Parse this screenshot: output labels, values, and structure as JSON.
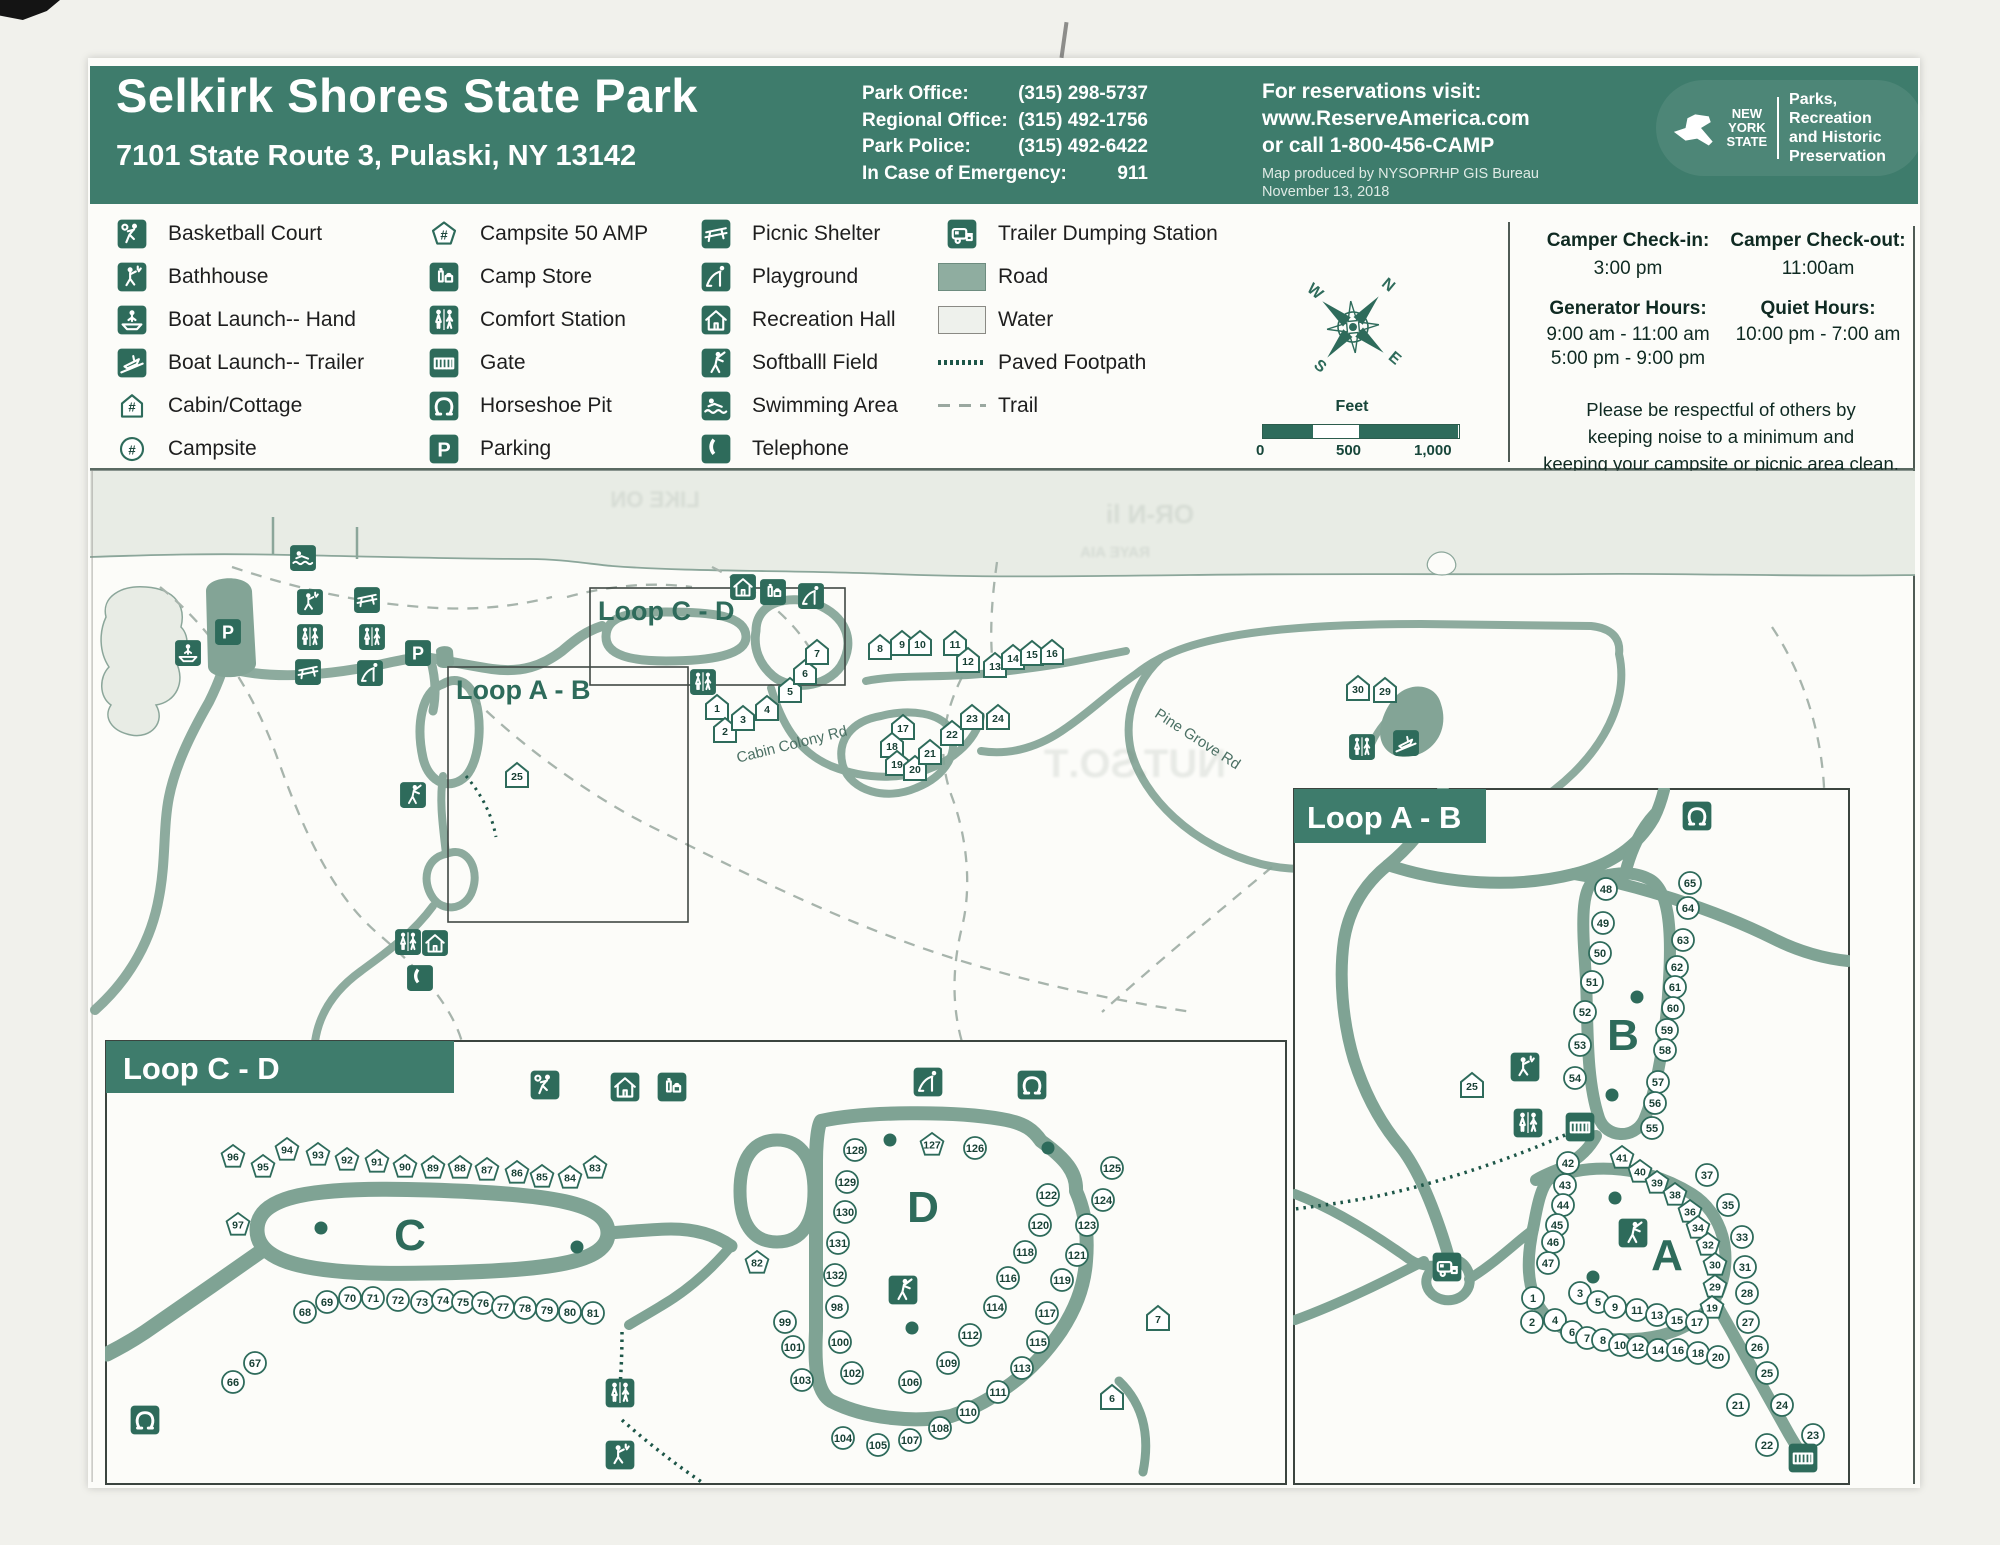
{
  "header": {
    "title": "Selkirk Shores State Park",
    "address": "7101 State Route 3, Pulaski, NY 13142",
    "contacts": [
      {
        "label": "Park Office:",
        "value": "(315) 298-5737"
      },
      {
        "label": "Regional Office:",
        "value": "(315) 492-1756"
      },
      {
        "label": "Park Police:",
        "value": "(315) 492-6422"
      },
      {
        "label": "In Case of Emergency:",
        "value": "911"
      }
    ],
    "reservations": [
      "For reservations visit:",
      "www.ReserveAmerica.com",
      "or call 1-800-456-CAMP"
    ],
    "produced": [
      "Map produced by NYSOPRHP GIS Bureau",
      "November 13, 2018"
    ],
    "logo": {
      "state": [
        "NEW",
        "YORK",
        "STATE"
      ],
      "dept": [
        "Parks, Recreation",
        "and Historic",
        "Preservation"
      ]
    }
  },
  "legend": {
    "columns": [
      [
        {
          "icon": "basketball",
          "label": "Basketball Court"
        },
        {
          "icon": "bathhouse",
          "label": "Bathhouse"
        },
        {
          "icon": "boat-hand",
          "label": "Boat Launch-- Hand"
        },
        {
          "icon": "boat-trailer",
          "label": "Boat Launch-- Trailer"
        },
        {
          "icon": "cabin",
          "label": "Cabin/Cottage"
        },
        {
          "icon": "campsite",
          "label": "Campsite"
        }
      ],
      [
        {
          "icon": "campsite50",
          "label": "Campsite 50 AMP"
        },
        {
          "icon": "campstore",
          "label": "Camp Store"
        },
        {
          "icon": "comfort",
          "label": "Comfort Station"
        },
        {
          "icon": "gate",
          "label": "Gate"
        },
        {
          "icon": "horseshoe",
          "label": "Horseshoe Pit"
        },
        {
          "icon": "parking",
          "label": "Parking"
        }
      ],
      [
        {
          "icon": "picnic",
          "label": "Picnic Shelter"
        },
        {
          "icon": "playground",
          "label": "Playground"
        },
        {
          "icon": "rechall",
          "label": "Recreation Hall"
        },
        {
          "icon": "softball",
          "label": "Softballl Field"
        },
        {
          "icon": "swim",
          "label": "Swimming Area"
        },
        {
          "icon": "telephone",
          "label": "Telephone"
        }
      ],
      [
        {
          "icon": "dump",
          "label": "Trailer Dumping Station"
        },
        {
          "icon": "road-swatch",
          "label": "Road",
          "variant": "swatch"
        },
        {
          "icon": "water-swatch",
          "label": "Water",
          "variant": "swatch"
        },
        {
          "icon": "footpath-line",
          "label": "Paved Footpath",
          "variant": "line"
        },
        {
          "icon": "trail-line",
          "label": "Trail",
          "variant": "line"
        }
      ]
    ]
  },
  "info_panel": {
    "checkin_title": "Camper Check-in:",
    "checkin_value": "3:00 pm",
    "checkout_title": "Camper Check-out:",
    "checkout_value": "11:00am",
    "generator_title": "Generator Hours:",
    "generator_lines": [
      "9:00 am - 11:00 am",
      "5:00 pm - 9:00 pm"
    ],
    "quiet_title": "Quiet Hours:",
    "quiet_value": "10:00 pm - 7:00 am",
    "note": [
      "Please be respectful of others by",
      "keeping noise to a minimum and",
      "keeping your campsite or picnic area clean."
    ]
  },
  "scalebar": {
    "label": "Feet",
    "ticks": [
      "0",
      "500",
      "1,000"
    ]
  },
  "compass": {
    "letters": [
      "N",
      "E",
      "S",
      "W"
    ]
  },
  "colors": {
    "header_green": "#3e7c6c",
    "icon_green": "#2e6b5b",
    "road": "#83a496",
    "water": "#e8ece5"
  },
  "main_map": {
    "boxes": [
      {
        "label": "Loop C - D"
      },
      {
        "label": "Loop A - B"
      }
    ],
    "road_labels": [
      {
        "text": "Cabin Colony Rd"
      },
      {
        "text": "Pine Grove Rd"
      }
    ],
    "cabins": [
      [
        1,
        627,
        242
      ],
      [
        2,
        635,
        265
      ],
      [
        3,
        653,
        253
      ],
      [
        4,
        677,
        243
      ],
      [
        5,
        700,
        225
      ],
      [
        6,
        715,
        207
      ],
      [
        7,
        727,
        187
      ],
      [
        8,
        790,
        182
      ],
      [
        9,
        812,
        178
      ],
      [
        10,
        830,
        178
      ],
      [
        11,
        865,
        178
      ],
      [
        12,
        878,
        195
      ],
      [
        13,
        905,
        200
      ],
      [
        14,
        923,
        192
      ],
      [
        15,
        942,
        188
      ],
      [
        16,
        962,
        187
      ],
      [
        17,
        813,
        262
      ],
      [
        18,
        802,
        280
      ],
      [
        19,
        807,
        298
      ],
      [
        20,
        825,
        303
      ],
      [
        21,
        840,
        287
      ],
      [
        22,
        862,
        268
      ],
      [
        23,
        882,
        252
      ],
      [
        24,
        908,
        252
      ],
      [
        25,
        427,
        310
      ],
      [
        29,
        1295,
        225
      ],
      [
        30,
        1268,
        223
      ]
    ],
    "icons": [
      [
        "swim",
        213,
        93
      ],
      [
        "boat-hand",
        98,
        188
      ],
      [
        "parking",
        138,
        167
      ],
      [
        "bathhouse",
        220,
        137
      ],
      [
        "picnic",
        277,
        135
      ],
      [
        "comfort",
        220,
        172
      ],
      [
        "comfort",
        282,
        172
      ],
      [
        "picnic",
        218,
        207
      ],
      [
        "playground",
        280,
        208
      ],
      [
        "parking",
        328,
        188
      ],
      [
        "softball",
        323,
        330
      ],
      [
        "comfort",
        613,
        217
      ],
      [
        "rechall",
        653,
        122
      ],
      [
        "campstore",
        683,
        127
      ],
      [
        "playground",
        721,
        131
      ],
      [
        "comfort",
        318,
        477
      ],
      [
        "rechall",
        345,
        478
      ],
      [
        "telephone",
        330,
        513
      ],
      [
        "comfort",
        1272,
        282
      ],
      [
        "boat-trailer",
        1316,
        278
      ]
    ],
    "artifacts": [
      {
        "text": "OR-N li",
        "x": 1060,
        "y": 58,
        "s": 26
      },
      {
        "text": "RAYE AIA",
        "x": 1025,
        "y": 92,
        "s": 15
      },
      {
        "text": "LIKE ON",
        "x": 565,
        "y": 42,
        "s": 22
      },
      {
        "text": "NUT.SO.T",
        "x": 1045,
        "y": 312,
        "s": 40
      }
    ]
  },
  "inset_cd": {
    "title": "Loop C - D",
    "letters": [
      {
        "t": "C",
        "x": 305,
        "y": 210
      },
      {
        "t": "D",
        "x": 818,
        "y": 182
      }
    ],
    "pentagons": [
      [
        96,
        128,
        117
      ],
      [
        95,
        158,
        127
      ],
      [
        94,
        182,
        110
      ],
      [
        93,
        213,
        115
      ],
      [
        92,
        242,
        120
      ],
      [
        91,
        272,
        122
      ],
      [
        90,
        300,
        127
      ],
      [
        89,
        328,
        128
      ],
      [
        88,
        355,
        128
      ],
      [
        87,
        382,
        130
      ],
      [
        86,
        412,
        133
      ],
      [
        85,
        437,
        137
      ],
      [
        84,
        465,
        138
      ],
      [
        83,
        490,
        128
      ],
      [
        97,
        133,
        185
      ],
      [
        82,
        652,
        223
      ],
      [
        127,
        827,
        105
      ]
    ],
    "circles": [
      [
        68,
        200,
        272
      ],
      [
        69,
        222,
        262
      ],
      [
        70,
        245,
        258
      ],
      [
        71,
        268,
        258
      ],
      [
        72,
        293,
        260
      ],
      [
        73,
        317,
        262
      ],
      [
        74,
        338,
        260
      ],
      [
        75,
        358,
        262
      ],
      [
        76,
        378,
        263
      ],
      [
        77,
        398,
        267
      ],
      [
        78,
        420,
        268
      ],
      [
        79,
        442,
        270
      ],
      [
        80,
        465,
        272
      ],
      [
        81,
        488,
        273
      ],
      [
        66,
        128,
        342
      ],
      [
        67,
        150,
        323
      ],
      [
        128,
        750,
        110
      ],
      [
        129,
        742,
        142
      ],
      [
        130,
        740,
        172
      ],
      [
        131,
        733,
        203
      ],
      [
        132,
        730,
        235
      ],
      [
        98,
        732,
        267
      ],
      [
        100,
        735,
        302
      ],
      [
        102,
        747,
        333
      ],
      [
        106,
        805,
        342
      ],
      [
        109,
        843,
        323
      ],
      [
        99,
        680,
        282
      ],
      [
        101,
        688,
        307
      ],
      [
        103,
        697,
        340
      ],
      [
        104,
        738,
        398
      ],
      [
        105,
        773,
        405
      ],
      [
        107,
        805,
        400
      ],
      [
        108,
        835,
        388
      ],
      [
        110,
        863,
        372
      ],
      [
        111,
        893,
        352
      ],
      [
        113,
        917,
        328
      ],
      [
        115,
        933,
        302
      ],
      [
        117,
        942,
        273
      ],
      [
        119,
        957,
        240
      ],
      [
        121,
        972,
        215
      ],
      [
        123,
        982,
        185
      ],
      [
        124,
        998,
        160
      ],
      [
        125,
        1007,
        128
      ],
      [
        122,
        943,
        155
      ],
      [
        120,
        935,
        185
      ],
      [
        118,
        920,
        212
      ],
      [
        116,
        903,
        238
      ],
      [
        114,
        890,
        267
      ],
      [
        112,
        865,
        295
      ],
      [
        126,
        870,
        108
      ]
    ],
    "cabins": [
      [
        7,
        1053,
        278
      ],
      [
        6,
        1007,
        357
      ]
    ],
    "icons": [
      [
        "basketball",
        440,
        45
      ],
      [
        "rechall",
        520,
        47
      ],
      [
        "campstore",
        567,
        47
      ],
      [
        "playground",
        823,
        42
      ],
      [
        "horseshoe",
        927,
        45
      ],
      [
        "horseshoe",
        40,
        380
      ],
      [
        "comfort",
        515,
        353
      ],
      [
        "bathhouse",
        515,
        415
      ],
      [
        "softball",
        798,
        250
      ]
    ],
    "dots": [
      [
        216,
        188
      ],
      [
        472,
        207
      ],
      [
        785,
        100
      ],
      [
        943,
        108
      ],
      [
        807,
        288
      ]
    ]
  },
  "inset_ab": {
    "title": "Loop A - B",
    "letters": [
      {
        "t": "B",
        "x": 330,
        "y": 262
      },
      {
        "t": "A",
        "x": 374,
        "y": 482
      }
    ],
    "circles": [
      [
        48,
        313,
        101
      ],
      [
        49,
        310,
        135
      ],
      [
        50,
        307,
        165
      ],
      [
        51,
        299,
        194
      ],
      [
        52,
        292,
        224
      ],
      [
        53,
        287,
        257
      ],
      [
        54,
        282,
        290
      ],
      [
        65,
        397,
        95
      ],
      [
        64,
        395,
        120
      ],
      [
        63,
        390,
        152
      ],
      [
        62,
        384,
        179
      ],
      [
        61,
        382,
        199
      ],
      [
        60,
        380,
        220
      ],
      [
        59,
        374,
        242
      ],
      [
        58,
        372,
        262
      ],
      [
        57,
        365,
        294
      ],
      [
        56,
        362,
        315
      ],
      [
        55,
        359,
        340
      ],
      [
        42,
        275,
        375
      ],
      [
        43,
        272,
        397
      ],
      [
        44,
        270,
        417
      ],
      [
        45,
        264,
        437
      ],
      [
        46,
        260,
        454
      ],
      [
        47,
        255,
        475
      ],
      [
        37,
        414,
        387
      ],
      [
        35,
        435,
        417
      ],
      [
        33,
        449,
        449
      ],
      [
        31,
        452,
        479
      ],
      [
        28,
        454,
        505
      ],
      [
        27,
        455,
        534
      ],
      [
        26,
        464,
        559
      ],
      [
        25,
        474,
        585
      ],
      [
        24,
        489,
        617
      ],
      [
        23,
        520,
        647
      ],
      [
        22,
        474,
        657
      ],
      [
        21,
        445,
        617
      ],
      [
        1,
        240,
        510
      ],
      [
        2,
        239,
        534
      ],
      [
        3,
        287,
        505
      ],
      [
        4,
        262,
        532
      ],
      [
        5,
        305,
        514
      ],
      [
        6,
        279,
        544
      ],
      [
        7,
        294,
        550
      ],
      [
        8,
        310,
        552
      ],
      [
        9,
        322,
        519
      ],
      [
        10,
        327,
        557
      ],
      [
        11,
        344,
        522
      ],
      [
        12,
        345,
        559
      ],
      [
        13,
        364,
        527
      ],
      [
        14,
        365,
        562
      ],
      [
        15,
        384,
        532
      ],
      [
        16,
        385,
        562
      ],
      [
        17,
        404,
        534
      ],
      [
        18,
        405,
        565
      ],
      [
        20,
        425,
        569
      ]
    ],
    "pentagons": [
      [
        41,
        329,
        370
      ],
      [
        40,
        347,
        384
      ],
      [
        39,
        364,
        395
      ],
      [
        38,
        382,
        407
      ],
      [
        36,
        397,
        424
      ],
      [
        34,
        405,
        440
      ],
      [
        32,
        415,
        457
      ],
      [
        30,
        422,
        477
      ],
      [
        29,
        422,
        499
      ],
      [
        19,
        419,
        520
      ]
    ],
    "cabins": [
      [
        25,
        179,
        297
      ]
    ],
    "icons": [
      [
        "horseshoe",
        404,
        28
      ],
      [
        "bathhouse",
        232,
        279
      ],
      [
        "comfort",
        235,
        335
      ],
      [
        "gate",
        287,
        339
      ],
      [
        "dump",
        154,
        479
      ],
      [
        "softball",
        340,
        445
      ],
      [
        "gate",
        510,
        670
      ]
    ],
    "dots": [
      [
        344,
        209
      ],
      [
        319,
        307
      ],
      [
        322,
        410
      ],
      [
        300,
        489
      ]
    ]
  }
}
